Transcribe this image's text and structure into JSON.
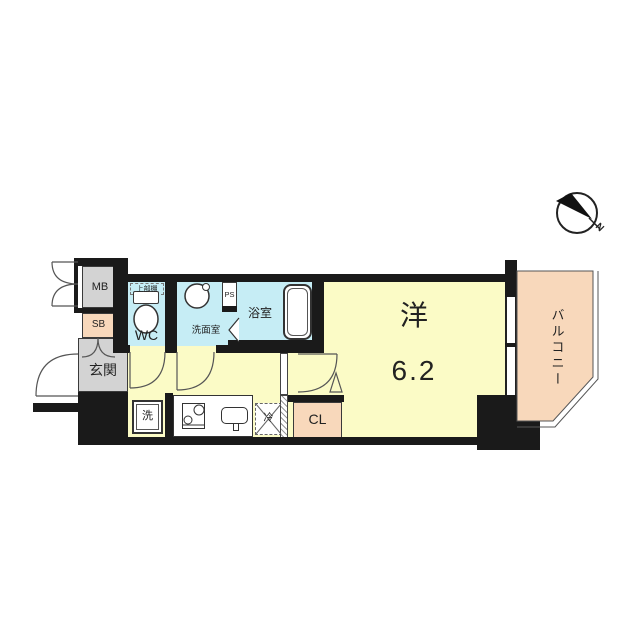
{
  "floorplan": {
    "rooms": {
      "meter_box": {
        "label": "MB"
      },
      "shoe_box": {
        "label": "SB"
      },
      "entrance": {
        "label": "玄関"
      },
      "toilet": {
        "label": "WC"
      },
      "upper_shelf": {
        "label": "上部棚"
      },
      "washroom": {
        "label": "洗面室"
      },
      "pipe_space": {
        "label": "PS"
      },
      "bathroom": {
        "label": "浴室"
      },
      "washer": {
        "label": "洗"
      },
      "fridge": {
        "label": "冷"
      },
      "closet": {
        "label": "CL"
      },
      "western_room": {
        "label": "洋",
        "size": "6.2"
      },
      "balcony": {
        "label": "バルコニー"
      }
    },
    "compass": {
      "north_label": "N"
    },
    "colors": {
      "wall": "#1a1a1a",
      "floor_yellow": "#fbfbc6",
      "wet_area_cyan": "#c6edf5",
      "service_peach": "#f8d8bb",
      "hall_gray": "#d3d3d3",
      "line": "#444444"
    }
  }
}
